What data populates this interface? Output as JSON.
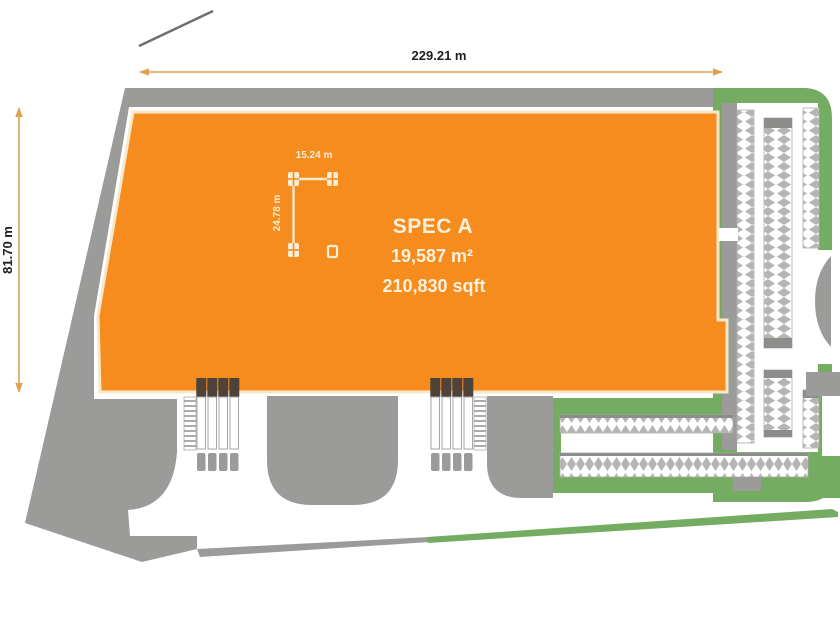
{
  "site_plan": {
    "building": {
      "name": "SPEC A",
      "area_metric": "19,587 m²",
      "area_imperial": "210,830 sqft"
    },
    "dimensions": {
      "overall_width": "229.21 m",
      "overall_depth": "81.70 m",
      "column_grid_width": "15.24 m",
      "column_grid_depth": "24.78 m"
    },
    "colors": {
      "building_fill": "#F68C1E",
      "building_outline": "#F6E8CA",
      "building_label_text": "#FAF1DC",
      "dimension_line": "#DFA24E",
      "dimension_text": "#1F1F1F",
      "pavement_gray": "#9B9B99",
      "pavement_dark_gray": "#8D8D8B",
      "landscape_green": "#74AC62",
      "parking_hatch_gray": "#B5B5B3",
      "dock_door_dark": "#4E4239",
      "boundary_line_gray": "#6E6E6E"
    }
  }
}
